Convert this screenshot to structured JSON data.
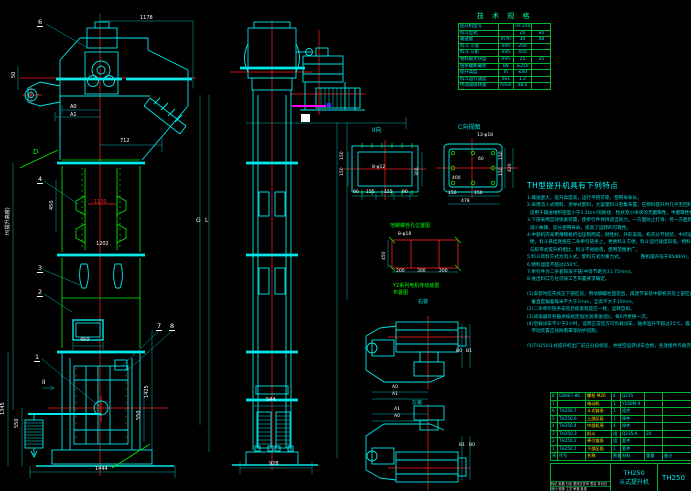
{
  "colors": {
    "bg": "#000000",
    "cyan": "#00e8e8",
    "green": "#00ff00",
    "red": "#ff2222",
    "white": "#ffffff",
    "magenta": "#ff00ff",
    "yellow": "#ffee00",
    "blue": "#3333ff",
    "table_border": "#00b435"
  },
  "spec_table": {
    "title": "技 术 规 格",
    "rows": [
      [
        "提升机型号",
        "",
        "TH 250",
        ""
      ],
      [
        "料斗型式",
        "",
        "Zh",
        "Sh"
      ],
      [
        "输送量",
        "m³/h",
        "30",
        "48"
      ],
      [
        "料斗 斗宽",
        "mm",
        "250",
        ""
      ],
      [
        "料斗 斗距",
        "mm",
        "450",
        ""
      ],
      [
        "物料最大块度",
        "mm",
        "25",
        "35"
      ],
      [
        "链条破断载荷",
        "kN",
        "≥250",
        ""
      ],
      [
        "提升高度",
        "m",
        "≤40",
        ""
      ],
      [
        "料斗运行速度",
        "m/s",
        "1.2",
        ""
      ],
      [
        "传动滚筒转速",
        "r/min",
        "48.0",
        ""
      ]
    ]
  },
  "notes": {
    "title": "TH型提升机具有下列特点",
    "lines": [
      "1.输送量大，提升高度高，运行平稳可靠，使用寿命长。",
      "2.采用流入式喂料，诱导式卸料，大容量料斗密集布置，在物料提升时几乎无回料和挖料现象，故无效功率小，",
      "  适用于输送堆积密度小于1.5t/m³的粉状、粒状及小块状的无磨琢性、半磨琢性物料。",
      "3.下部采用自动张紧装置，使牵引件保持适当张力，一方面防止打滑，另一方面防止链条脱轨，运行平稳，大大",
      "  减少故障，延长使用寿命，提高了运转的可靠性。",
      "4.中部机壳采用薄钢板折边压制而成，刚性好，外形美观。机壳分节组装，中间设有检修门的机壳，安装检修方",
      "  便。料斗悬挂连接在二条牵引链条上，更换料斗方便，料斗运行速度较低，物料的破碎率小。",
      "  与胶带式提升机相比，料斗不易脱落，使用范围更广。",
      "5.料斗装料方式为流入式，卸料方式为重力式。            整机噪声低于85dB(A)，运转平稳。",
      "6.物料温度不超过250℃。",
      "7.牵引件为二条套筒滚子链(中等节距为31.75mm)。",
      "8.进出料口方位可按工艺布置要求确定。",
      "",
      "(1)安装时应先找正下部区段，用地脚螺栓固定后，再逐节安装中部机壳及上部区段，机壳安装",
      "   垂直度偏差每米不大于1mm，全高不大于10mm。",
      "(2)二条牵引链条安装后松紧程度应一致，运转自如。",
      "(3)减速器及各轴承按规定加注润滑油(脂)，每6月更换一次。",
      "(4)空载试车不少于2小时，运转正常后方可负载试车，轴承温升不超过25℃，露天使用时，",
      "   传动装置应加防雨罩等防护措施。",
      "",
      "(5)TH250斗式提升机出厂前已分段组装，并经空运转试车合格，各连接件齐备完好。"
    ]
  },
  "parts_table": {
    "rows": [
      [
        "8",
        "GB907-86",
        "螺栓 M20",
        "4",
        "Q235",
        "",
        ""
      ],
      [
        "7",
        "",
        "电动机",
        "1",
        "Y160M-4",
        "",
        ""
      ],
      [
        "6",
        "TH250.7",
        "斗式链条",
        "1",
        "组件",
        "",
        ""
      ],
      [
        "5",
        "TH250.6",
        "上部区段",
        "1",
        "焊件",
        "",
        ""
      ],
      [
        "4",
        "TH250.4",
        "中部机壳",
        "4",
        "焊件",
        "",
        ""
      ],
      [
        "3",
        "TH250.3",
        "料斗",
        "组",
        "Q235-A",
        "20",
        ""
      ],
      [
        "2",
        "TH250.2",
        "牵引链条",
        "组",
        "套件",
        "",
        ""
      ],
      [
        "1",
        "TH250.1",
        "下部区段",
        "1",
        "套件",
        "",
        ""
      ],
      [
        "序号",
        "代号",
        "名称",
        "数量",
        "材料",
        "重量",
        "备注"
      ]
    ]
  },
  "title_block": {
    "model": "TH250",
    "product": "斗式提升机",
    "right_code": "TH250",
    "rev_line": "标记 处数 分区 更改文件号 签名 年月日",
    "sign_line": "设计  校核  工艺  审核  批准"
  },
  "labels": [
    {
      "t": "1178",
      "x": 140,
      "y": 16
    },
    {
      "t": "712",
      "x": 120,
      "y": 139
    },
    {
      "t": "A0",
      "x": 70,
      "y": 105,
      "s": 5
    },
    {
      "t": "A1",
      "x": 70,
      "y": 113,
      "s": 5
    },
    {
      "t": "50",
      "x": 12,
      "y": 78,
      "r": 1
    },
    {
      "t": "D",
      "x": 33,
      "y": 149,
      "c": "green",
      "s": 7
    },
    {
      "t": "450",
      "x": 50,
      "y": 210,
      "r": 1
    },
    {
      "t": "1130",
      "x": 94,
      "y": 200,
      "c": "red"
    },
    {
      "t": "1202",
      "x": 96,
      "y": 242
    },
    {
      "t": "H(提升高度)",
      "x": 6,
      "y": 235,
      "r": 1
    },
    {
      "t": "G",
      "x": 196,
      "y": 218,
      "s": 6
    },
    {
      "t": "L",
      "x": 205,
      "y": 218,
      "s": 6
    },
    {
      "t": "II",
      "x": 42,
      "y": 380,
      "s": 6
    },
    {
      "t": "450",
      "x": 80,
      "y": 338
    },
    {
      "t": "1345",
      "x": 1,
      "y": 415,
      "r": 1
    },
    {
      "t": "550",
      "x": 15,
      "y": 428,
      "r": 1
    },
    {
      "t": "1425",
      "x": 145,
      "y": 398,
      "r": 1
    },
    {
      "t": "550",
      "x": 137,
      "y": 420,
      "r": 1
    },
    {
      "t": "1444",
      "x": 95,
      "y": 467
    },
    {
      "t": "544",
      "x": 266,
      "y": 398
    },
    {
      "t": "928",
      "x": 269,
      "y": 462
    },
    {
      "t": "II向",
      "x": 372,
      "y": 128,
      "c": "cyan",
      "s": 6
    },
    {
      "t": "8-φ12",
      "x": 372,
      "y": 166,
      "s": 4.5
    },
    {
      "t": "150",
      "x": 341,
      "y": 160,
      "r": 1,
      "s": 4.5
    },
    {
      "t": "150",
      "x": 341,
      "y": 176,
      "r": 1,
      "s": 4.5
    },
    {
      "t": "300",
      "x": 416,
      "y": 176,
      "r": 1,
      "s": 4.5
    },
    {
      "t": "90",
      "x": 353,
      "y": 191,
      "s": 4.5
    },
    {
      "t": "155",
      "x": 366,
      "y": 191,
      "s": 4.5
    },
    {
      "t": "155",
      "x": 384,
      "y": 191,
      "s": 4.5
    },
    {
      "t": "90",
      "x": 402,
      "y": 191,
      "s": 4.5
    },
    {
      "t": "C向视图",
      "x": 458,
      "y": 125,
      "c": "cyan",
      "s": 6
    },
    {
      "t": "13-φ18",
      "x": 477,
      "y": 134,
      "s": 4.5
    },
    {
      "t": "60",
      "x": 478,
      "y": 158,
      "s": 4.5
    },
    {
      "t": "400",
      "x": 452,
      "y": 177,
      "s": 4.5
    },
    {
      "t": "150",
      "x": 448,
      "y": 192,
      "s": 4.5
    },
    {
      "t": "150",
      "x": 474,
      "y": 192,
      "s": 4.5
    },
    {
      "t": "478",
      "x": 461,
      "y": 200,
      "s": 4.5
    },
    {
      "t": "150",
      "x": 500,
      "y": 160,
      "r": 1,
      "s": 4.5
    },
    {
      "t": "150",
      "x": 500,
      "y": 176,
      "r": 1,
      "s": 4.5
    },
    {
      "t": "420",
      "x": 509,
      "y": 172,
      "r": 1,
      "s": 4.5
    },
    {
      "t": "地脚螺栓孔位置图",
      "x": 390,
      "y": 224,
      "c": "green"
    },
    {
      "t": "8-φ18",
      "x": 398,
      "y": 233,
      "s": 4.5
    },
    {
      "t": "450",
      "x": 383,
      "y": 260,
      "r": 1,
      "s": 4.5
    },
    {
      "t": "200",
      "x": 396,
      "y": 270,
      "s": 4.5
    },
    {
      "t": "300",
      "x": 417,
      "y": 270,
      "s": 4.5
    },
    {
      "t": "200",
      "x": 439,
      "y": 270,
      "s": 4.5
    },
    {
      "t": "Y2系列电机传动装置",
      "x": 393,
      "y": 284,
      "c": "green"
    },
    {
      "t": "布置图",
      "x": 393,
      "y": 291,
      "c": "green"
    },
    {
      "t": "右装",
      "x": 418,
      "y": 300,
      "c": "cyan"
    },
    {
      "t": "B0",
      "x": 456,
      "y": 350,
      "s": 4.5
    },
    {
      "t": "B1",
      "x": 466,
      "y": 350,
      "s": 4.5
    },
    {
      "t": "A0",
      "x": 392,
      "y": 386,
      "s": 4.5
    },
    {
      "t": "A1",
      "x": 392,
      "y": 393,
      "s": 4.5
    },
    {
      "t": "左装",
      "x": 412,
      "y": 401,
      "c": "cyan"
    },
    {
      "t": "A1",
      "x": 394,
      "y": 408,
      "s": 4.5
    },
    {
      "t": "A0",
      "x": 394,
      "y": 415,
      "s": 4.5
    },
    {
      "t": "B1",
      "x": 459,
      "y": 444,
      "s": 4.5
    },
    {
      "t": "B0",
      "x": 469,
      "y": 444,
      "s": 4.5
    }
  ],
  "balloons": [
    {
      "n": "6",
      "x": 37,
      "y": 19
    },
    {
      "n": "4",
      "x": 37,
      "y": 176
    },
    {
      "n": "3",
      "x": 37,
      "y": 265
    },
    {
      "n": "2",
      "x": 37,
      "y": 289
    },
    {
      "n": "1",
      "x": 34,
      "y": 354
    },
    {
      "n": "7",
      "x": 156,
      "y": 323
    },
    {
      "n": "8",
      "x": 169,
      "y": 323
    }
  ]
}
